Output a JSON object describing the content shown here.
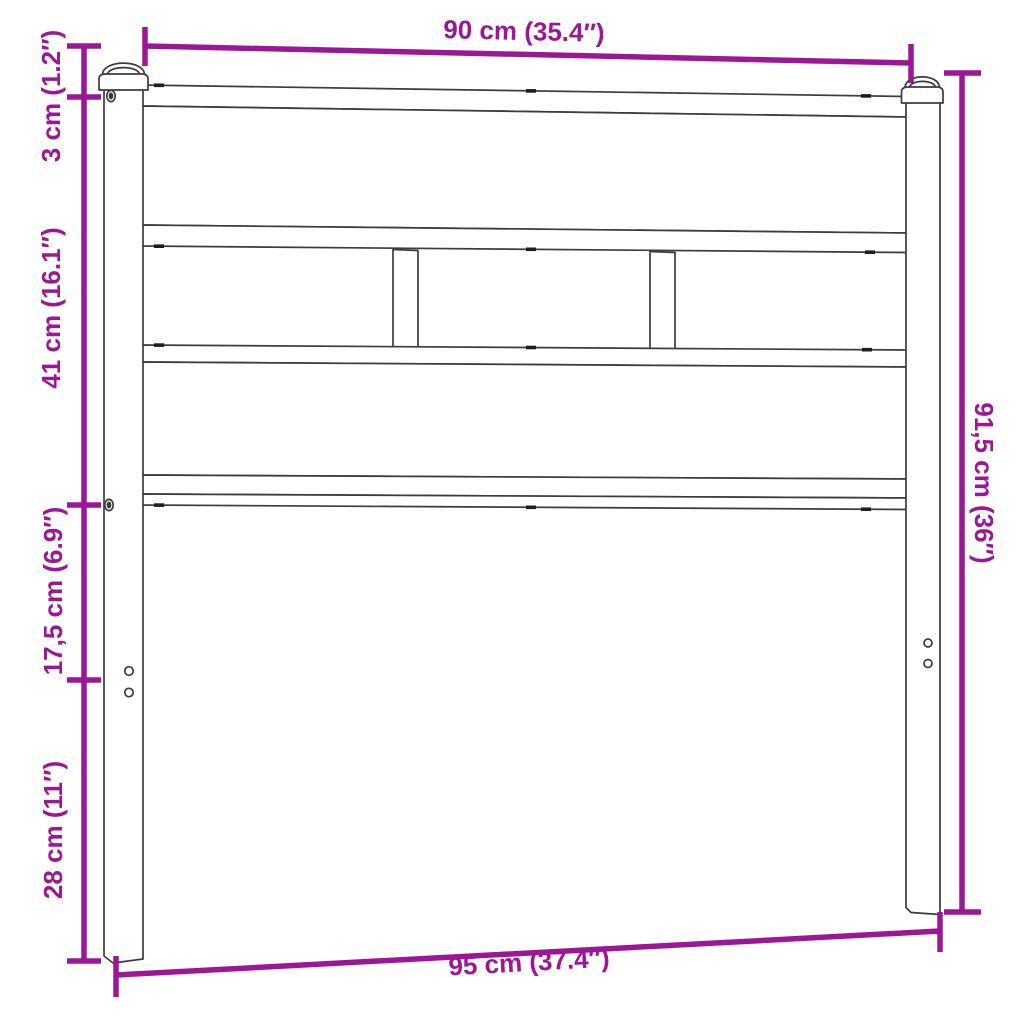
{
  "colors": {
    "accent": "#9B1796",
    "line": "#3C3C3C",
    "bg": "#FFFFFF"
  },
  "dimensions": {
    "top_width": {
      "label": "90 cm (35.4″)"
    },
    "bottom_width": {
      "label": "95 cm (37.4″)"
    },
    "right_height": {
      "label": "91,5 cm (36″)"
    },
    "left_segments": [
      {
        "label": "3 cm (1.2″)"
      },
      {
        "label": "41 cm (16.1″)"
      },
      {
        "label": "17,5 cm (6.9″)"
      },
      {
        "label": "28 cm (11″)"
      }
    ]
  }
}
